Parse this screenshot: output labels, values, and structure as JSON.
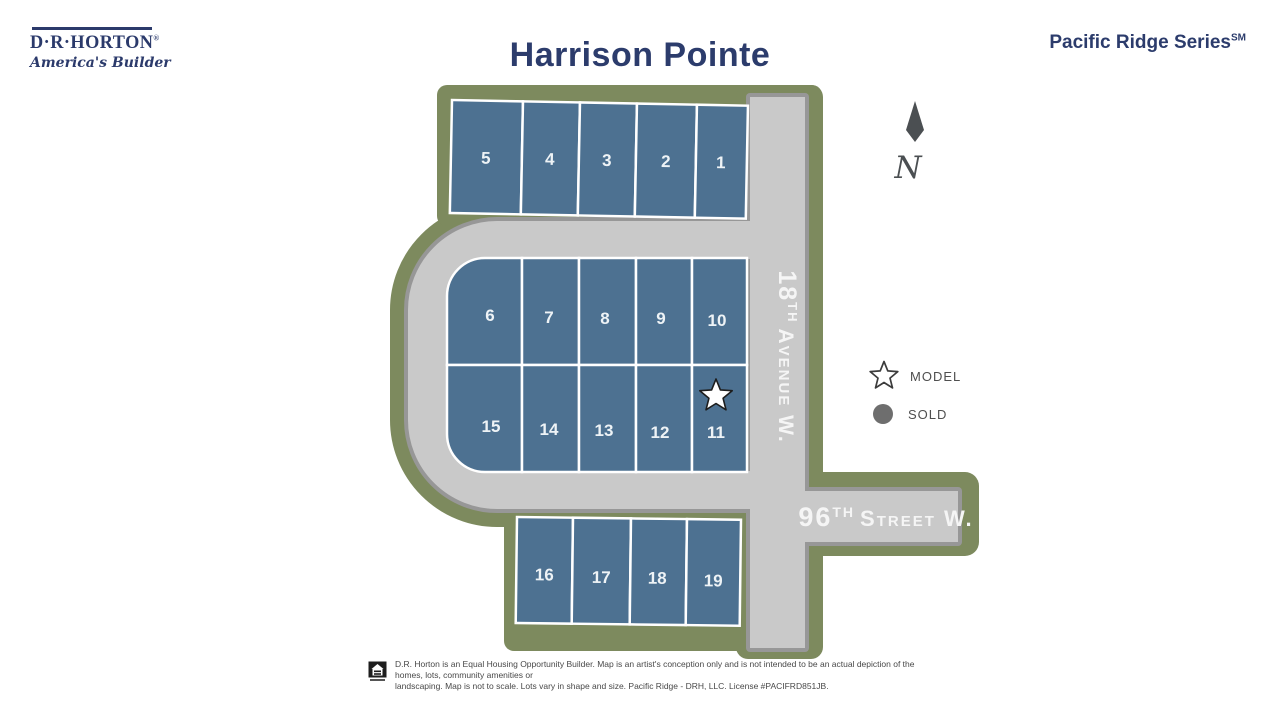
{
  "header": {
    "logo_name": "D·R·HORTON",
    "logo_reg": "®",
    "logo_tagline": "America's Builder",
    "title": "Harrison Pointe",
    "series": "Pacific Ridge Series",
    "series_mark": "SM"
  },
  "map": {
    "north": "N",
    "streets": [
      {
        "name": "18th Avenue W.",
        "num": "18",
        "ordinal": "TH",
        "rest": "Avenue W."
      },
      {
        "name": "96th Street W.",
        "num": "96",
        "ordinal": "TH",
        "rest": "Street W."
      }
    ],
    "lots": [
      {
        "number": "5",
        "status": "available"
      },
      {
        "number": "4",
        "status": "available"
      },
      {
        "number": "3",
        "status": "available"
      },
      {
        "number": "2",
        "status": "available"
      },
      {
        "number": "1",
        "status": "available"
      },
      {
        "number": "6",
        "status": "available"
      },
      {
        "number": "7",
        "status": "available"
      },
      {
        "number": "8",
        "status": "available"
      },
      {
        "number": "9",
        "status": "available"
      },
      {
        "number": "10",
        "status": "available"
      },
      {
        "number": "15",
        "status": "available"
      },
      {
        "number": "14",
        "status": "available"
      },
      {
        "number": "13",
        "status": "available"
      },
      {
        "number": "12",
        "status": "available"
      },
      {
        "number": "11",
        "status": "model"
      },
      {
        "number": "16",
        "status": "available"
      },
      {
        "number": "17",
        "status": "available"
      },
      {
        "number": "18",
        "status": "available"
      },
      {
        "number": "19",
        "status": "available"
      }
    ]
  },
  "legend": {
    "model": "MODEL",
    "sold": "SOLD"
  },
  "footer": {
    "line1": "D.R. Horton is an Equal Housing Opportunity Builder. Map is an artist's conception only and is not intended to be an actual depiction of the homes, lots, community amenities or",
    "line2": "landscaping. Map is not to scale. Lots vary in shape and size. Pacific Ridge - DRH, LLC. License #PACIFRD851JB."
  },
  "colors": {
    "lot_blue": "#4d7191",
    "boundary_green": "#7d8a5e",
    "road_gray": "#c9c9c9",
    "road_border": "#979797",
    "brand_navy": "#2c3c6c"
  }
}
